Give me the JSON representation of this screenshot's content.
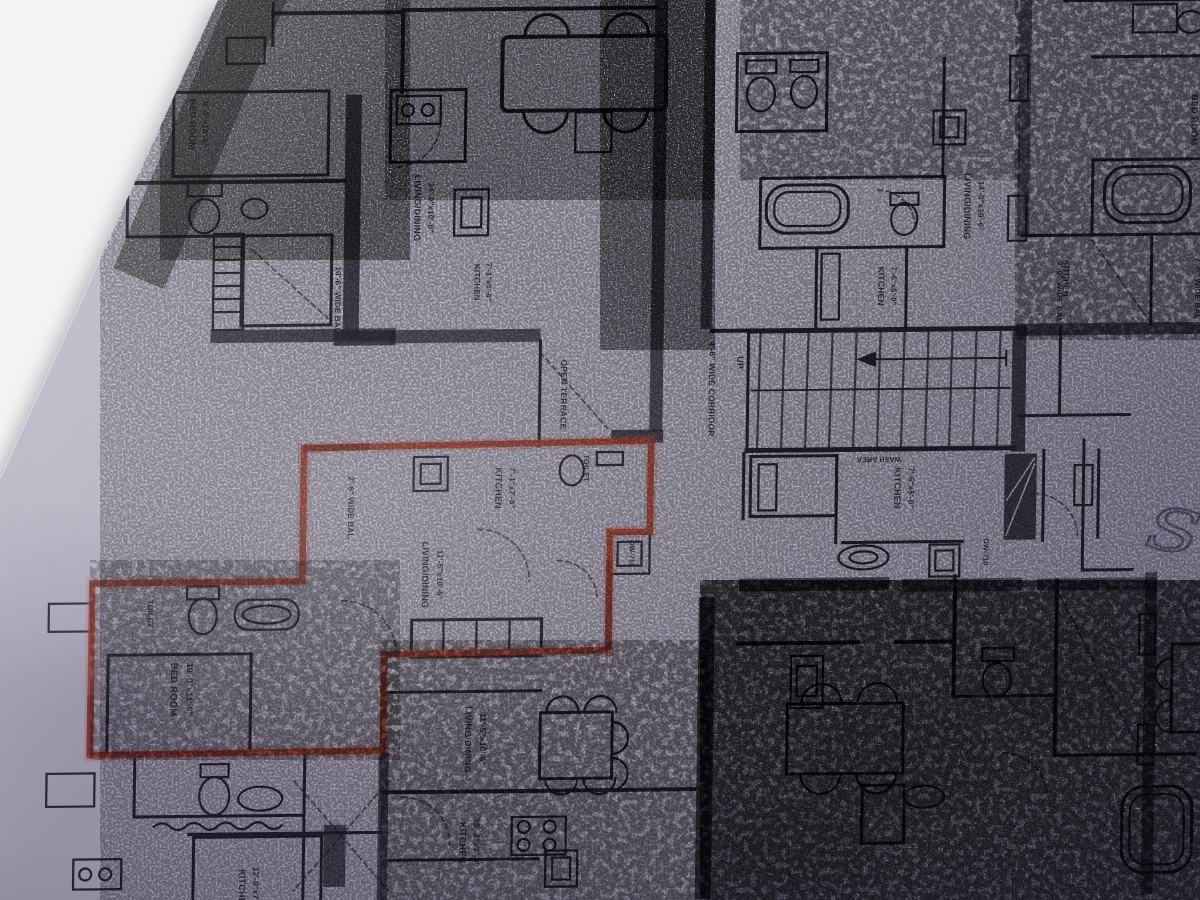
{
  "colors": {
    "background_surface": "#eef0ef",
    "paper": "#aca7b8",
    "ink": "#262430",
    "highlight_red": "#9a3d2f",
    "pen_blue": "#4a5474"
  },
  "handwriting": {
    "text": "S"
  },
  "floor_plan": {
    "highlighted_unit": {
      "outline_color": "#9a3d2f"
    },
    "labels": [
      {
        "t": "BED ROOM",
        "x": 186,
        "y": 120,
        "r": 90,
        "s": 9
      },
      {
        "t": "8'-0\"x10'-0\"",
        "x": 199,
        "y": 120,
        "r": 90,
        "s": 8
      },
      {
        "t": "10'-6\" WIDE BAL.",
        "x": 334,
        "y": 298,
        "r": 90,
        "s": 8
      },
      {
        "t": "LIVING/DINING",
        "x": 412,
        "y": 206,
        "r": 90,
        "s": 9
      },
      {
        "t": "14'-0\"x10'-6\"",
        "x": 426,
        "y": 206,
        "r": 90,
        "s": 8
      },
      {
        "t": "KITCHEN",
        "x": 473,
        "y": 281,
        "r": 90,
        "s": 8
      },
      {
        "t": "7'-1\"x5'-6\"",
        "x": 485,
        "y": 281,
        "r": 90,
        "s": 7.5
      },
      {
        "t": "OPEN TERRACE",
        "x": 561,
        "y": 394,
        "r": 90,
        "s": 8.5
      },
      {
        "t": "4'-6\" WIDE CORRIDOR",
        "x": 709,
        "y": 390,
        "r": 90,
        "s": 8.5
      },
      {
        "t": "UP",
        "x": 737,
        "y": 364,
        "r": 90,
        "s": 9
      },
      {
        "t": "2'-6\" WIDE BAL.",
        "x": 350,
        "y": 506,
        "r": 90,
        "s": 8
      },
      {
        "t": "KITCHEN",
        "x": 497,
        "y": 487,
        "r": 90,
        "s": 9
      },
      {
        "t": "7'-1\"x7'-6\"",
        "x": 511,
        "y": 487,
        "r": 90,
        "s": 8
      },
      {
        "t": "TOILET",
        "x": 585,
        "y": 468,
        "r": 90,
        "s": 7.5
      },
      {
        "t": "DW-710",
        "x": 632,
        "y": 554,
        "r": 90,
        "s": 7
      },
      {
        "t": "LIVING/DINING",
        "x": 425,
        "y": 573,
        "r": 90,
        "s": 9
      },
      {
        "t": "11'-5\"x10'-6\"",
        "x": 440,
        "y": 573,
        "r": 90,
        "s": 8
      },
      {
        "t": "TOILET",
        "x": 151,
        "y": 609,
        "r": 90,
        "s": 7.5
      },
      {
        "t": "BED ROOM",
        "x": 175,
        "y": 685,
        "r": 90,
        "s": 9.5
      },
      {
        "t": "10'-0\"x11'-6\"",
        "x": 191,
        "y": 685,
        "r": 90,
        "s": 8.5
      },
      {
        "t": "WASH AREA",
        "x": 880,
        "y": 460,
        "r": 180,
        "s": 7
      },
      {
        "t": "KITCHEN",
        "x": 896,
        "y": 491,
        "r": 90,
        "s": 9
      },
      {
        "t": "7'-6\"x5'-0\"",
        "x": 910,
        "y": 491,
        "r": 90,
        "s": 8
      },
      {
        "t": "DW-710",
        "x": 986,
        "y": 556,
        "r": 90,
        "s": 7
      },
      {
        "t": "KITCHEN",
        "x": 877,
        "y": 289,
        "r": 90,
        "s": 8.5
      },
      {
        "t": "7'-6\"x5'-0\"",
        "x": 890,
        "y": 289,
        "r": 90,
        "s": 7.5
      },
      {
        "t": "LIVING/DINING",
        "x": 962,
        "y": 210,
        "r": 90,
        "s": 9
      },
      {
        "t": "14'-0\"x10'-6\"",
        "x": 976,
        "y": 210,
        "r": 90,
        "s": 8
      },
      {
        "t": "3'-0\" WIDE BAL.",
        "x": 1056,
        "y": 298,
        "r": 90,
        "s": 8
      },
      {
        "t": "BED ROOM",
        "x": 1188,
        "y": 126,
        "r": 90,
        "s": 9
      },
      {
        "t": "7'-0\" WIDE BAL.",
        "x": 1194,
        "y": 296,
        "r": 90,
        "s": 8
      },
      {
        "t": "KITCHEN",
        "x": 1062,
        "y": 283,
        "r": 90,
        "s": 8
      },
      {
        "t": "LIVING/DINING",
        "x": 470,
        "y": 738,
        "r": 90,
        "s": 9
      },
      {
        "t": "11'-5\"x10'-6\"",
        "x": 485,
        "y": 738,
        "r": 90,
        "s": 8.5
      },
      {
        "t": "KITCHEN",
        "x": 466,
        "y": 841,
        "r": 90,
        "s": 9
      },
      {
        "t": "15'-2\"x7'-0\"",
        "x": 480,
        "y": 841,
        "r": 90,
        "s": 8.5
      },
      {
        "t": "KITCHEN",
        "x": 246,
        "y": 886,
        "r": 90,
        "s": 9
      },
      {
        "t": "12'-0\"x7'-0\"",
        "x": 260,
        "y": 886,
        "r": 90,
        "s": 8
      }
    ]
  }
}
